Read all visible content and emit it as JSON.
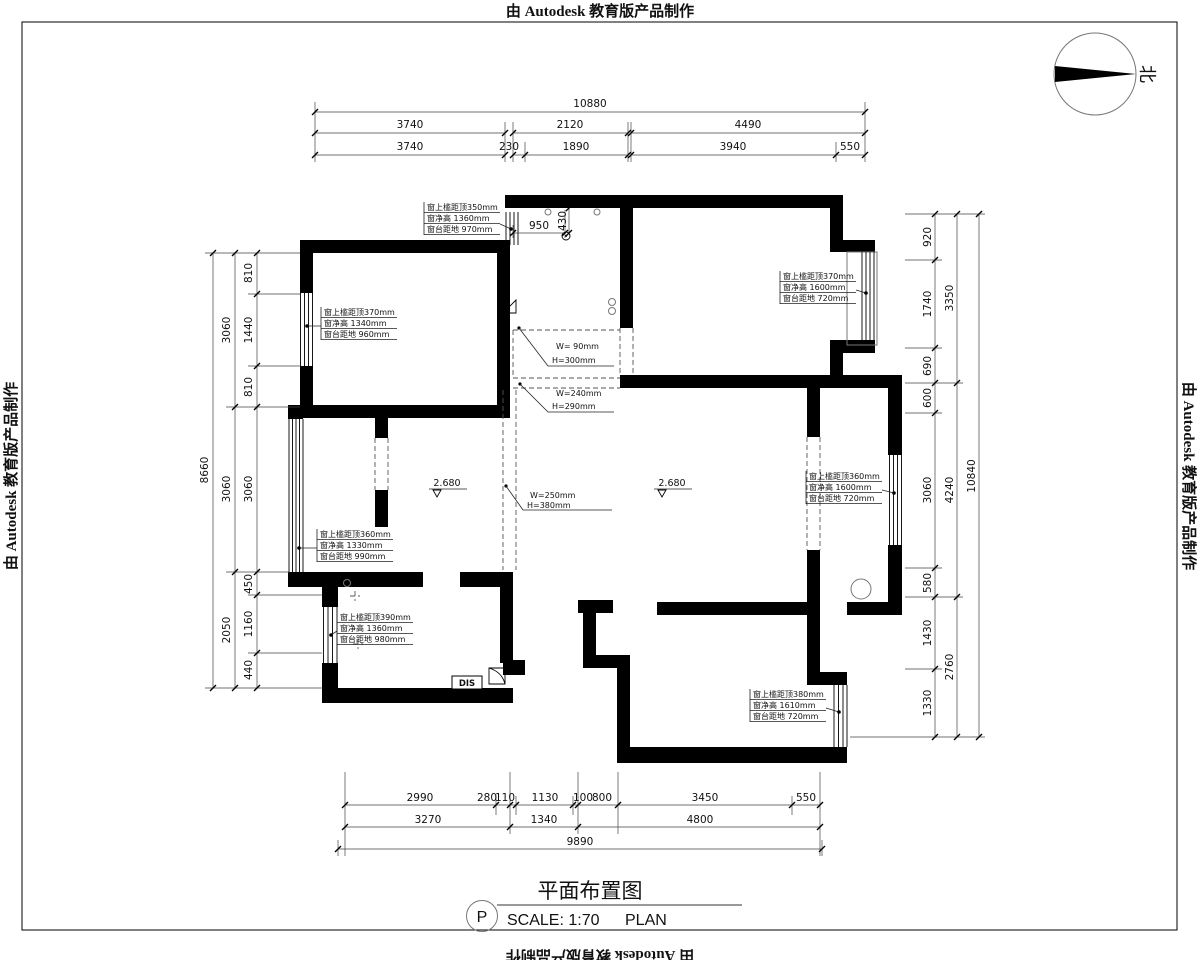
{
  "stamp": {
    "text": "由 Autodesk 教育版产品制作"
  },
  "north_label": "北",
  "title_block": {
    "name": "平面布置图",
    "tag": "P",
    "scale": "SCALE: 1:70",
    "type": "PLAN"
  },
  "dims": {
    "top": {
      "total": "10880",
      "row2": [
        "3740",
        "2120",
        "4490"
      ],
      "row3": [
        "3740",
        "230",
        "1890",
        "3940",
        "550"
      ]
    },
    "bottom": {
      "row1": [
        "2990",
        "280",
        "110",
        "1130",
        "100",
        "800",
        "3450",
        "550"
      ],
      "row2": [
        "3270",
        "1340",
        "4800"
      ],
      "total": "9890"
    },
    "left": {
      "total": "8660",
      "mid": [
        "3060",
        "3060",
        "2050"
      ],
      "inner": [
        "810",
        "1440",
        "810",
        "3060",
        "450",
        "1160",
        "440"
      ]
    },
    "right": {
      "total": "10840",
      "mid": [
        "3350",
        "4240",
        "2760"
      ],
      "inner": [
        "920",
        "1740",
        "690",
        "600",
        "3060",
        "580",
        "1430",
        "1330"
      ]
    },
    "kitchen_window": [
      "950",
      "430"
    ]
  },
  "levels": [
    {
      "value": "2.680"
    },
    {
      "value": "2.680"
    }
  ],
  "window_annotations": [
    {
      "l1": "窗上槛距顶350mm",
      "l2": "窗净高   1360mm",
      "l3": "窗台距地   970mm"
    },
    {
      "l1": "窗上槛距顶370mm",
      "l2": "窗净高   1340mm",
      "l3": "窗台距地   960mm"
    },
    {
      "l1": "窗上槛距顶370mm",
      "l2": "窗净高   1600mm",
      "l3": "窗台距地   720mm"
    },
    {
      "l1": "窗上槛距顶360mm",
      "l2": "窗净高   1600mm",
      "l3": "窗台距地   720mm"
    },
    {
      "l1": "窗上槛距顶360mm",
      "l2": "窗净高   1330mm",
      "l3": "窗台距地   990mm"
    },
    {
      "l1": "窗上槛距顶390mm",
      "l2": "窗净高   1360mm",
      "l3": "窗台距地   980mm"
    },
    {
      "l1": "窗上槛距顶380mm",
      "l2": "窗净高   1610mm",
      "l3": "窗台距地   720mm"
    }
  ],
  "opening_annotations": [
    {
      "w": "W= 90mm",
      "h": "H=300mm"
    },
    {
      "w": "W=240mm",
      "h": "H=290mm"
    },
    {
      "w": "W=250mm",
      "h": "H=380mm"
    }
  ],
  "labels": {
    "dis": "DIS"
  }
}
